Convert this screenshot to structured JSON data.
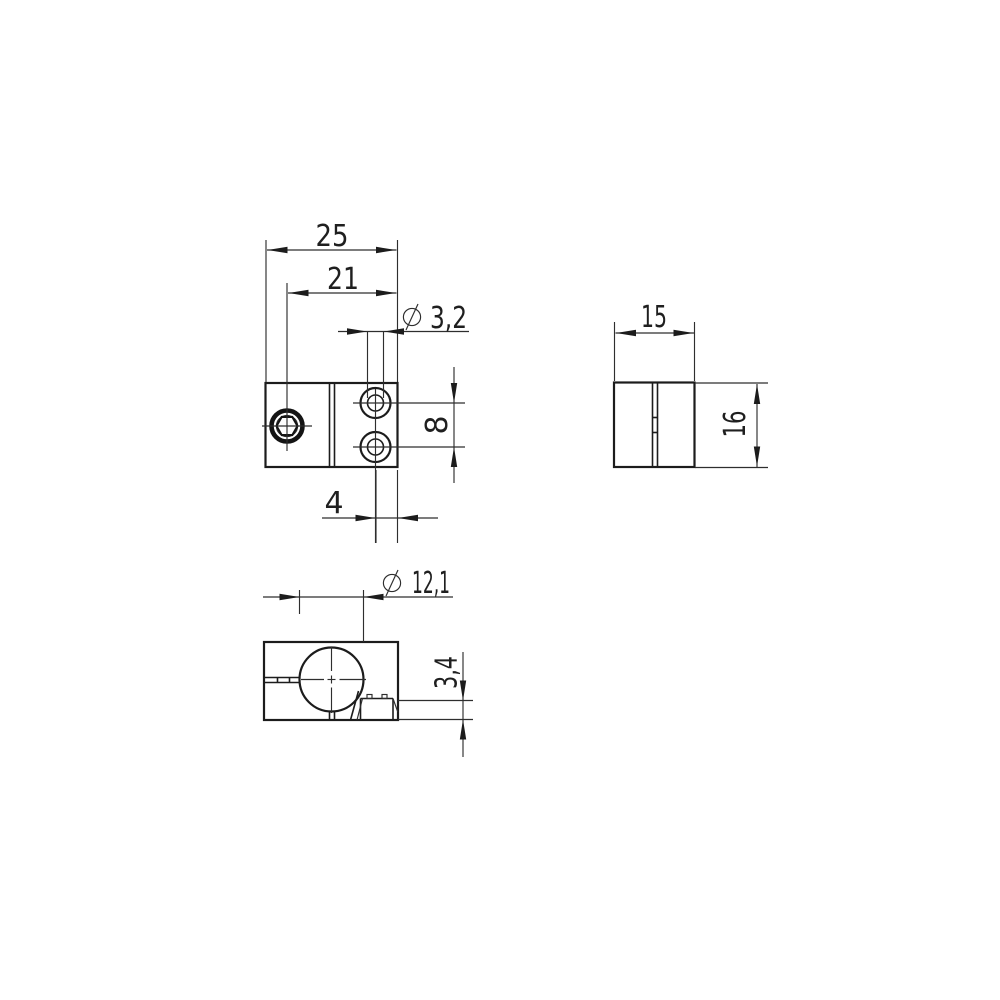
{
  "drawing": {
    "type": "technical-orthographic-drawing",
    "background_color": "#ffffff",
    "line_color": "#1c1c1c",
    "symbols": {
      "diameter": "⌀"
    },
    "views": {
      "front": "front view with clamp screw and two counterbored holes",
      "side": "side view with clamping slit",
      "bottom": "bottom view with round bore, slit and pocket"
    },
    "dimensions": {
      "front_width": "25",
      "screw_to_edge": "21",
      "small_hole_diameter": "3,2",
      "hole_spacing": "8",
      "hole_to_edge": "4",
      "side_depth": "15",
      "block_height": "16",
      "bore_diameter": "12,1",
      "pocket_depth": "3,4"
    }
  }
}
